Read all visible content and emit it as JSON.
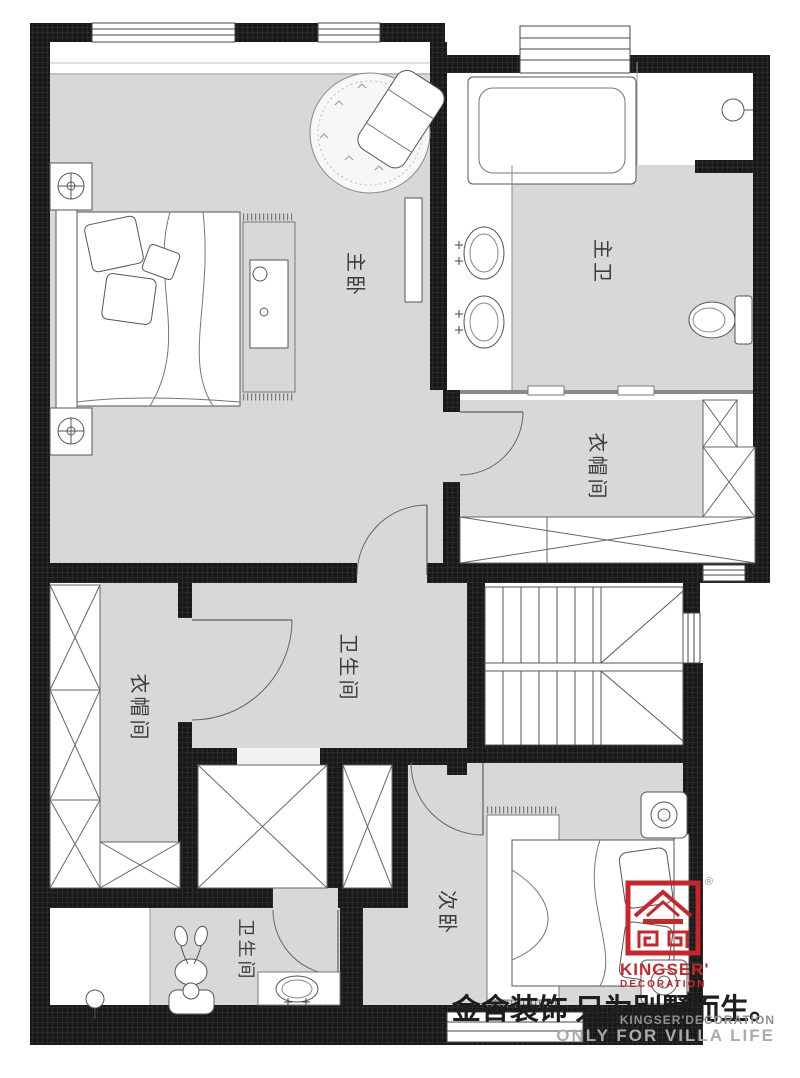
{
  "rooms": {
    "master_bedroom": {
      "label": "主卧"
    },
    "master_bath": {
      "label": "主卫"
    },
    "cloakroom_right": {
      "label": "衣帽间"
    },
    "cloakroom_left": {
      "label": "衣帽间"
    },
    "bathroom_center": {
      "label": "卫生间"
    },
    "bathroom_bottom": {
      "label": "卫生间"
    },
    "second_bedroom": {
      "label": "次卧"
    }
  },
  "branding": {
    "logo_line1": "KINGSER'",
    "logo_line2": "DECORATION",
    "registered_mark": "®",
    "slogan_cn": "金舍装饰 只为别墅而生。",
    "footer_en_line1": "KINGSER'DECORATION",
    "footer_en_line2": "ONLY FOR VILLA LIFE",
    "colors": {
      "logo_red": "#c8262b",
      "footer_gray": "#9b9b9b",
      "wall_black": "#1a1a1a",
      "floor_gray": "#d8d8d8"
    }
  }
}
